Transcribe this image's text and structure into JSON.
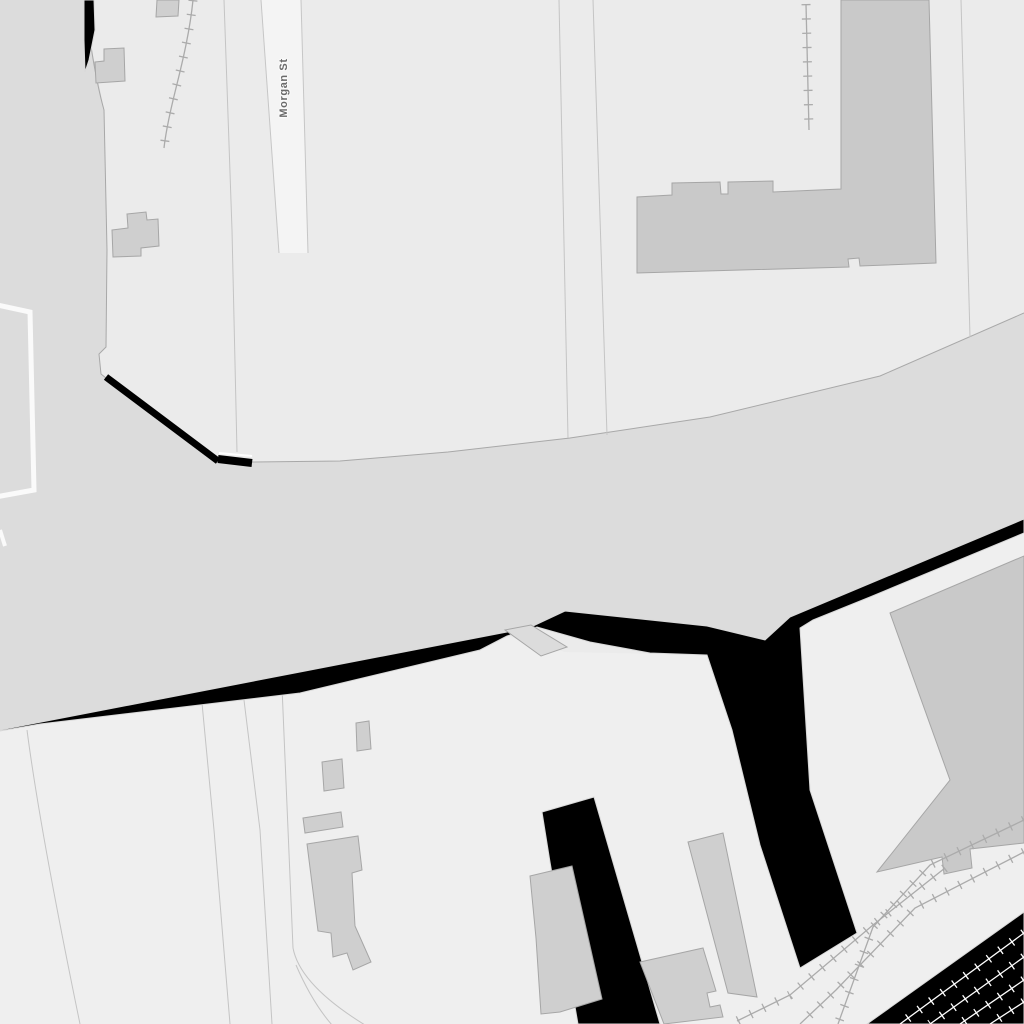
{
  "map": {
    "street_label": "Morgan St",
    "layers": [
      "background",
      "lower-area",
      "road-plaza",
      "street-morgan",
      "parcel-lines",
      "white-outlined-lot",
      "water-black",
      "pier",
      "buildings",
      "railways",
      "labels"
    ],
    "colors": {
      "background": "#ebebeb",
      "lower_area": "#efefef",
      "road": "#dcdcdc",
      "street_fill": "#f4f4f4",
      "street_casing": "#c6c6c6",
      "building": "#cfcfcf",
      "building_dark": "#c9c9c9",
      "building_outline": "#a6a6a6",
      "water_black": "#000000",
      "water_outline": "#d9d9d9",
      "boundary_line": "#c4c4c4",
      "road_edge": "#a8a8a8",
      "railway": "#ababab",
      "railway_white": "#ffffff",
      "white_outline": "#fafafa",
      "label_text": "#6a6a6a",
      "label_halo": "#ffffff"
    }
  }
}
